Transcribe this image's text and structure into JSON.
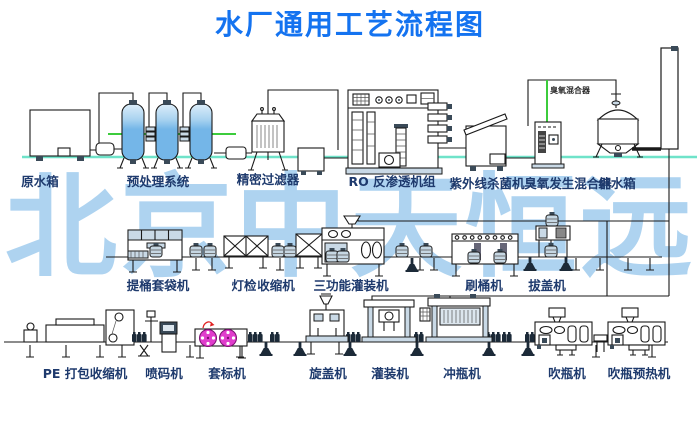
{
  "title": "水厂通用工艺流程图",
  "watermark": "北京中天恒远",
  "colors": {
    "title_blue": "#1473f0",
    "label_navy": "#1e3a6d",
    "watermark_blue": "#aed3f0",
    "pipe_green": "#3ccc3c",
    "ground_cyan": "#6fe3c9",
    "tank_blue": "#74b6e8",
    "machine_shade": "#c9d9e6",
    "label_roll_magenta": "#e03ccc",
    "accent_red": "#e02020",
    "line_black": "#1a1a1a"
  },
  "top_row": {
    "raw_water_tank": "原水箱",
    "pretreatment_system": "预处理系统",
    "precision_filter": "精密过滤器",
    "ro_unit": "RO 反渗透机组",
    "uv_sterilizer": "紫外线杀菌机",
    "ozone_generator_mixer": "臭氧发生混合器",
    "ozone_pipe_note": "臭氧混合器",
    "pure_water_tank": "纯水箱"
  },
  "middle_row": {
    "bucket_bagging_machine": "提桶套袋机",
    "lamp_inspection": "灯检",
    "shrink_machine": "收缩机",
    "three_function_filler": "三功能灌装机",
    "barrel_brushing_machine": "刷桶机",
    "cap_pulling_machine": "拔盖机"
  },
  "bottom_row": {
    "pe_pack_shrink_machine": "PE 打包收缩机",
    "inkjet_coding_machine": "喷码机",
    "sleeve_labeling_machine": "套标机",
    "capping_machine": "旋盖机",
    "filling_machine": "灌装机",
    "bottle_rinsing_machine": "冲瓶机",
    "bottle_blowing_machine": "吹瓶机",
    "bottle_preheating_machine": "吹瓶预热机"
  }
}
